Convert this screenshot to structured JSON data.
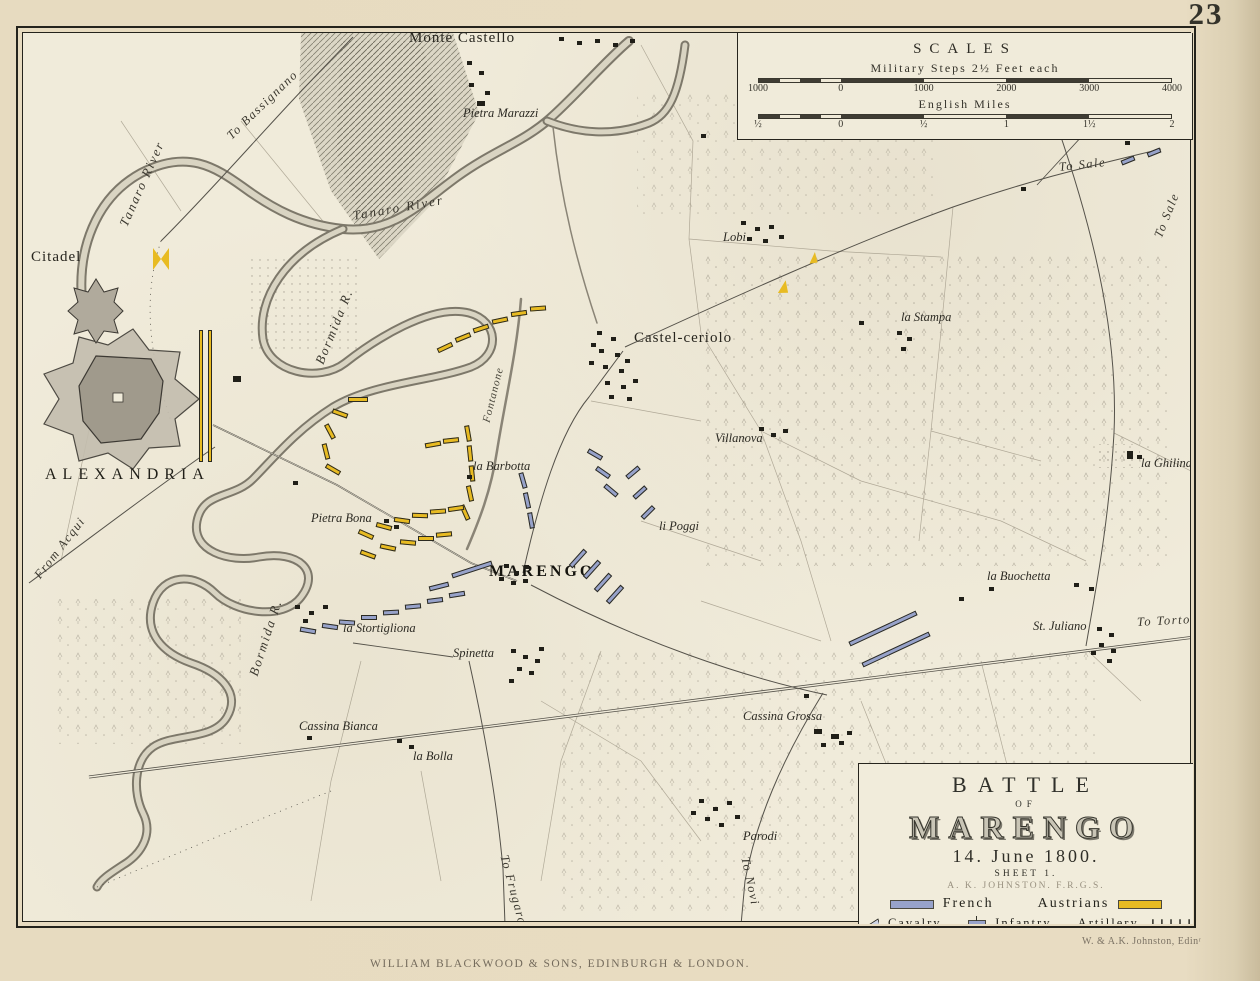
{
  "page": {
    "number": "23",
    "publisher": "WILLIAM BLACKWOOD & SONS, EDINBURGH & LONDON.",
    "engraver": "W. & A.K. Johnston, Edinʳ"
  },
  "scales": {
    "title": "SCALES",
    "bars": [
      {
        "label": "Military Steps 2½ Feet each",
        "ticks": [
          "1000",
          "0",
          "1000",
          "2000",
          "3000",
          "4000"
        ]
      },
      {
        "label": "English Miles",
        "ticks": [
          "½",
          "0",
          "½",
          "1",
          "1½",
          "2"
        ]
      }
    ]
  },
  "cartouche": {
    "line1": "BATTLE",
    "line2": "OF",
    "line3": "MARENGO",
    "date": "14. June 1800.",
    "sheet": "SHEET 1.",
    "author": "A. K. JOHNSTON. F.R.G.S.",
    "legend": {
      "french_label": "French",
      "austrians_label": "Austrians",
      "cavalry_label": "Cavalry",
      "infantry_label": "Infantry",
      "artillery_label": "Artillery",
      "artillery_symbol": "↓↓↓↓↓",
      "french_color": "#97a2ca",
      "austrian_color": "#e8bb22"
    }
  },
  "map": {
    "labels": [
      {
        "t": "Monte Castello",
        "x": 408,
        "y": 30,
        "c": "place"
      },
      {
        "t": "Pietra Marazzi",
        "x": 462,
        "y": 106,
        "c": "hamlet"
      },
      {
        "t": "Citadel",
        "x": 30,
        "y": 249,
        "c": "place"
      },
      {
        "t": "ALEXANDRIA",
        "x": 44,
        "y": 466,
        "c": "city"
      },
      {
        "t": "To Bassignano",
        "x": 228,
        "y": 130,
        "r": -44,
        "c": "road"
      },
      {
        "t": "Tanaro River",
        "x": 122,
        "y": 218,
        "r": -66,
        "c": "river"
      },
      {
        "t": "Tanaro River",
        "x": 352,
        "y": 208,
        "r": -10,
        "c": "river"
      },
      {
        "t": "Bormida R.",
        "x": 318,
        "y": 356,
        "r": -68,
        "c": "river"
      },
      {
        "t": "Bormida R.",
        "x": 252,
        "y": 668,
        "r": -72,
        "c": "river"
      },
      {
        "t": "Fontanone",
        "x": 486,
        "y": 416,
        "r": -76,
        "c": "riversm"
      },
      {
        "t": "Castel-ceriolo",
        "x": 633,
        "y": 330,
        "c": "place"
      },
      {
        "t": "Lobi",
        "x": 722,
        "y": 230,
        "c": "hamlet"
      },
      {
        "t": "la Stampa",
        "x": 900,
        "y": 310,
        "c": "hamlet"
      },
      {
        "t": "To Sale",
        "x": 1058,
        "y": 160,
        "r": -6,
        "c": "road"
      },
      {
        "t": "To Sale",
        "x": 1157,
        "y": 230,
        "r": -68,
        "c": "road"
      },
      {
        "t": "Villanova",
        "x": 714,
        "y": 431,
        "c": "hamlet"
      },
      {
        "t": "la Ghilina",
        "x": 1140,
        "y": 456,
        "c": "hamlet"
      },
      {
        "t": "la Barbotta",
        "x": 472,
        "y": 459,
        "c": "hamlet"
      },
      {
        "t": "Pietra Bona",
        "x": 310,
        "y": 511,
        "c": "hamlet"
      },
      {
        "t": "MARENGO",
        "x": 488,
        "y": 563,
        "c": "marengo"
      },
      {
        "t": "li Poggi",
        "x": 658,
        "y": 519,
        "c": "hamlet"
      },
      {
        "t": "la Buochetta",
        "x": 986,
        "y": 569,
        "c": "hamlet"
      },
      {
        "t": "St. Juliano",
        "x": 1032,
        "y": 619,
        "c": "hamlet"
      },
      {
        "t": "To Tortona",
        "x": 1136,
        "y": 615,
        "r": -3,
        "c": "road"
      },
      {
        "t": "la Stortigliona",
        "x": 342,
        "y": 621,
        "c": "hamlet"
      },
      {
        "t": "Spinetta",
        "x": 452,
        "y": 646,
        "c": "hamlet"
      },
      {
        "t": "Cassina Bianca",
        "x": 298,
        "y": 719,
        "c": "hamlet"
      },
      {
        "t": "la Bolla",
        "x": 412,
        "y": 749,
        "c": "hamlet"
      },
      {
        "t": "Cassina Grossa",
        "x": 742,
        "y": 709,
        "c": "hamlet"
      },
      {
        "t": "Parodi",
        "x": 742,
        "y": 829,
        "c": "hamlet"
      },
      {
        "t": "To Novi",
        "x": 744,
        "y": 850,
        "r": 78,
        "c": "road"
      },
      {
        "t": "To Frugarolo",
        "x": 503,
        "y": 848,
        "r": 75,
        "c": "road"
      },
      {
        "t": "From Acqui",
        "x": 36,
        "y": 570,
        "r": -52,
        "c": "road"
      }
    ],
    "units": [
      {
        "s": "A",
        "t": "bow",
        "x": 152,
        "y": 247,
        "w": 16,
        "h": 22
      },
      {
        "s": "A",
        "t": "col",
        "x": 198,
        "y": 329,
        "w": 4,
        "h": 132
      },
      {
        "s": "A",
        "t": "col",
        "x": 207,
        "y": 329,
        "w": 4,
        "h": 132
      },
      {
        "s": "A",
        "x": 436,
        "y": 344,
        "r": -25
      },
      {
        "s": "A",
        "x": 454,
        "y": 334,
        "r": -22
      },
      {
        "s": "A",
        "x": 472,
        "y": 325,
        "r": -18
      },
      {
        "s": "A",
        "x": 491,
        "y": 317,
        "r": -12
      },
      {
        "s": "A",
        "x": 510,
        "y": 310,
        "r": -8
      },
      {
        "s": "A",
        "x": 529,
        "y": 305,
        "r": -4
      },
      {
        "s": "A",
        "x": 347,
        "y": 396,
        "w": 20
      },
      {
        "s": "A",
        "x": 331,
        "y": 410,
        "r": 20
      },
      {
        "s": "A",
        "x": 321,
        "y": 428,
        "r": 62
      },
      {
        "s": "A",
        "x": 317,
        "y": 448,
        "r": 76
      },
      {
        "s": "A",
        "x": 324,
        "y": 466,
        "r": 30
      },
      {
        "s": "A",
        "x": 459,
        "y": 430,
        "r": 80
      },
      {
        "s": "A",
        "x": 461,
        "y": 450,
        "r": 84
      },
      {
        "s": "A",
        "x": 463,
        "y": 470,
        "r": 84
      },
      {
        "s": "A",
        "x": 461,
        "y": 490,
        "r": 78
      },
      {
        "s": "A",
        "x": 456,
        "y": 509,
        "r": 66
      },
      {
        "s": "A",
        "x": 424,
        "y": 441,
        "r": -10
      },
      {
        "s": "A",
        "x": 442,
        "y": 437,
        "r": -6
      },
      {
        "s": "A",
        "x": 357,
        "y": 531,
        "r": 24
      },
      {
        "s": "A",
        "x": 375,
        "y": 523,
        "r": 15
      },
      {
        "s": "A",
        "x": 393,
        "y": 517,
        "r": 8
      },
      {
        "s": "A",
        "x": 411,
        "y": 512,
        "r": 2
      },
      {
        "s": "A",
        "x": 429,
        "y": 508,
        "r": -4
      },
      {
        "s": "A",
        "x": 447,
        "y": 505,
        "r": -8
      },
      {
        "s": "A",
        "x": 359,
        "y": 551,
        "r": 20
      },
      {
        "s": "A",
        "x": 379,
        "y": 544,
        "r": 12
      },
      {
        "s": "A",
        "x": 399,
        "y": 539,
        "r": 5
      },
      {
        "s": "A",
        "x": 417,
        "y": 535
      },
      {
        "s": "A",
        "x": 435,
        "y": 531,
        "r": -5
      },
      {
        "s": "A",
        "t": "flag",
        "x": 778,
        "y": 279,
        "w": 10,
        "h": 14,
        "r": 10
      },
      {
        "s": "A",
        "t": "flag",
        "x": 809,
        "y": 251,
        "w": 8,
        "h": 12,
        "r": 5
      },
      {
        "s": "F",
        "x": 514,
        "y": 477,
        "r": 74
      },
      {
        "s": "F",
        "x": 518,
        "y": 497,
        "r": 78
      },
      {
        "s": "F",
        "x": 522,
        "y": 517,
        "r": 80
      },
      {
        "s": "F",
        "x": 586,
        "y": 451,
        "r": 30
      },
      {
        "s": "F",
        "x": 594,
        "y": 469,
        "r": 35
      },
      {
        "s": "F",
        "x": 602,
        "y": 487,
        "r": 40
      },
      {
        "s": "F",
        "x": 624,
        "y": 469,
        "r": -40
      },
      {
        "s": "F",
        "x": 631,
        "y": 489,
        "r": -42
      },
      {
        "s": "F",
        "x": 639,
        "y": 509,
        "r": -45
      },
      {
        "s": "F",
        "x": 566,
        "y": 555,
        "w": 22,
        "r": -48
      },
      {
        "s": "F",
        "x": 580,
        "y": 566,
        "w": 22,
        "r": -48
      },
      {
        "s": "F",
        "x": 591,
        "y": 579,
        "w": 22,
        "r": -48
      },
      {
        "s": "F",
        "x": 603,
        "y": 591,
        "w": 22,
        "r": -48
      },
      {
        "s": "F",
        "x": 845,
        "y": 625,
        "w": 74,
        "r": -25
      },
      {
        "s": "F",
        "x": 858,
        "y": 646,
        "w": 74,
        "r": -25
      },
      {
        "s": "F",
        "x": 450,
        "y": 566,
        "w": 42,
        "r": -18
      },
      {
        "s": "F",
        "x": 428,
        "y": 583,
        "w": 20,
        "r": -14
      },
      {
        "s": "F",
        "x": 338,
        "y": 619,
        "r": 4
      },
      {
        "s": "F",
        "x": 360,
        "y": 614
      },
      {
        "s": "F",
        "x": 382,
        "y": 609,
        "r": -3
      },
      {
        "s": "F",
        "x": 404,
        "y": 603,
        "r": -5
      },
      {
        "s": "F",
        "x": 426,
        "y": 597,
        "r": -7
      },
      {
        "s": "F",
        "x": 448,
        "y": 591,
        "r": -9
      },
      {
        "s": "F",
        "x": 299,
        "y": 627,
        "r": 10
      },
      {
        "s": "F",
        "x": 321,
        "y": 623,
        "r": 8
      },
      {
        "s": "F",
        "x": 1120,
        "y": 157,
        "w": 14,
        "r": -22
      },
      {
        "s": "F",
        "x": 1146,
        "y": 149,
        "w": 14,
        "r": -22
      }
    ],
    "buildings": [
      {
        "x": 558,
        "y": 36
      },
      {
        "x": 576,
        "y": 40
      },
      {
        "x": 594,
        "y": 38
      },
      {
        "x": 612,
        "y": 42
      },
      {
        "x": 629,
        "y": 38
      },
      {
        "x": 466,
        "y": 60
      },
      {
        "x": 478,
        "y": 70
      },
      {
        "x": 468,
        "y": 82
      },
      {
        "x": 484,
        "y": 90
      },
      {
        "x": 476,
        "y": 100,
        "w": 8,
        "h": 5
      },
      {
        "x": 596,
        "y": 330
      },
      {
        "x": 610,
        "y": 336
      },
      {
        "x": 598,
        "y": 348
      },
      {
        "x": 614,
        "y": 352
      },
      {
        "x": 602,
        "y": 364
      },
      {
        "x": 618,
        "y": 368
      },
      {
        "x": 604,
        "y": 380
      },
      {
        "x": 620,
        "y": 384
      },
      {
        "x": 608,
        "y": 394
      },
      {
        "x": 626,
        "y": 396
      },
      {
        "x": 590,
        "y": 342
      },
      {
        "x": 588,
        "y": 360
      },
      {
        "x": 632,
        "y": 378
      },
      {
        "x": 624,
        "y": 358
      },
      {
        "x": 740,
        "y": 220
      },
      {
        "x": 754,
        "y": 226
      },
      {
        "x": 768,
        "y": 224
      },
      {
        "x": 746,
        "y": 236
      },
      {
        "x": 762,
        "y": 238
      },
      {
        "x": 778,
        "y": 234
      },
      {
        "x": 896,
        "y": 330
      },
      {
        "x": 906,
        "y": 336
      },
      {
        "x": 900,
        "y": 346
      },
      {
        "x": 858,
        "y": 320
      },
      {
        "x": 758,
        "y": 426
      },
      {
        "x": 770,
        "y": 432
      },
      {
        "x": 782,
        "y": 428
      },
      {
        "x": 1126,
        "y": 450,
        "w": 6,
        "h": 8
      },
      {
        "x": 1136,
        "y": 454
      },
      {
        "x": 466,
        "y": 474
      },
      {
        "x": 383,
        "y": 518
      },
      {
        "x": 393,
        "y": 524
      },
      {
        "x": 503,
        "y": 563
      },
      {
        "x": 513,
        "y": 570
      },
      {
        "x": 523,
        "y": 564
      },
      {
        "x": 510,
        "y": 580
      },
      {
        "x": 522,
        "y": 578
      },
      {
        "x": 498,
        "y": 576
      },
      {
        "x": 510,
        "y": 648
      },
      {
        "x": 522,
        "y": 654
      },
      {
        "x": 534,
        "y": 658
      },
      {
        "x": 516,
        "y": 666
      },
      {
        "x": 528,
        "y": 670
      },
      {
        "x": 508,
        "y": 678
      },
      {
        "x": 538,
        "y": 646
      },
      {
        "x": 294,
        "y": 604
      },
      {
        "x": 308,
        "y": 610
      },
      {
        "x": 322,
        "y": 604
      },
      {
        "x": 302,
        "y": 618
      },
      {
        "x": 306,
        "y": 735
      },
      {
        "x": 396,
        "y": 738
      },
      {
        "x": 408,
        "y": 744
      },
      {
        "x": 813,
        "y": 728,
        "w": 8,
        "h": 5
      },
      {
        "x": 830,
        "y": 733,
        "w": 8,
        "h": 5
      },
      {
        "x": 846,
        "y": 730
      },
      {
        "x": 820,
        "y": 742
      },
      {
        "x": 838,
        "y": 740
      },
      {
        "x": 698,
        "y": 798
      },
      {
        "x": 712,
        "y": 806
      },
      {
        "x": 726,
        "y": 800
      },
      {
        "x": 704,
        "y": 816
      },
      {
        "x": 718,
        "y": 822
      },
      {
        "x": 734,
        "y": 814
      },
      {
        "x": 690,
        "y": 810
      },
      {
        "x": 1096,
        "y": 626
      },
      {
        "x": 1108,
        "y": 632
      },
      {
        "x": 1098,
        "y": 642
      },
      {
        "x": 1110,
        "y": 648
      },
      {
        "x": 1090,
        "y": 650
      },
      {
        "x": 1106,
        "y": 658
      },
      {
        "x": 988,
        "y": 586
      },
      {
        "x": 1073,
        "y": 582
      },
      {
        "x": 1088,
        "y": 586
      },
      {
        "x": 958,
        "y": 596
      },
      {
        "x": 760,
        "y": 53
      },
      {
        "x": 946,
        "y": 78
      },
      {
        "x": 1020,
        "y": 186
      },
      {
        "x": 1124,
        "y": 140
      },
      {
        "x": 803,
        "y": 693
      },
      {
        "x": 700,
        "y": 133
      },
      {
        "x": 232,
        "y": 375,
        "w": 8,
        "h": 6
      },
      {
        "x": 292,
        "y": 480
      }
    ]
  }
}
